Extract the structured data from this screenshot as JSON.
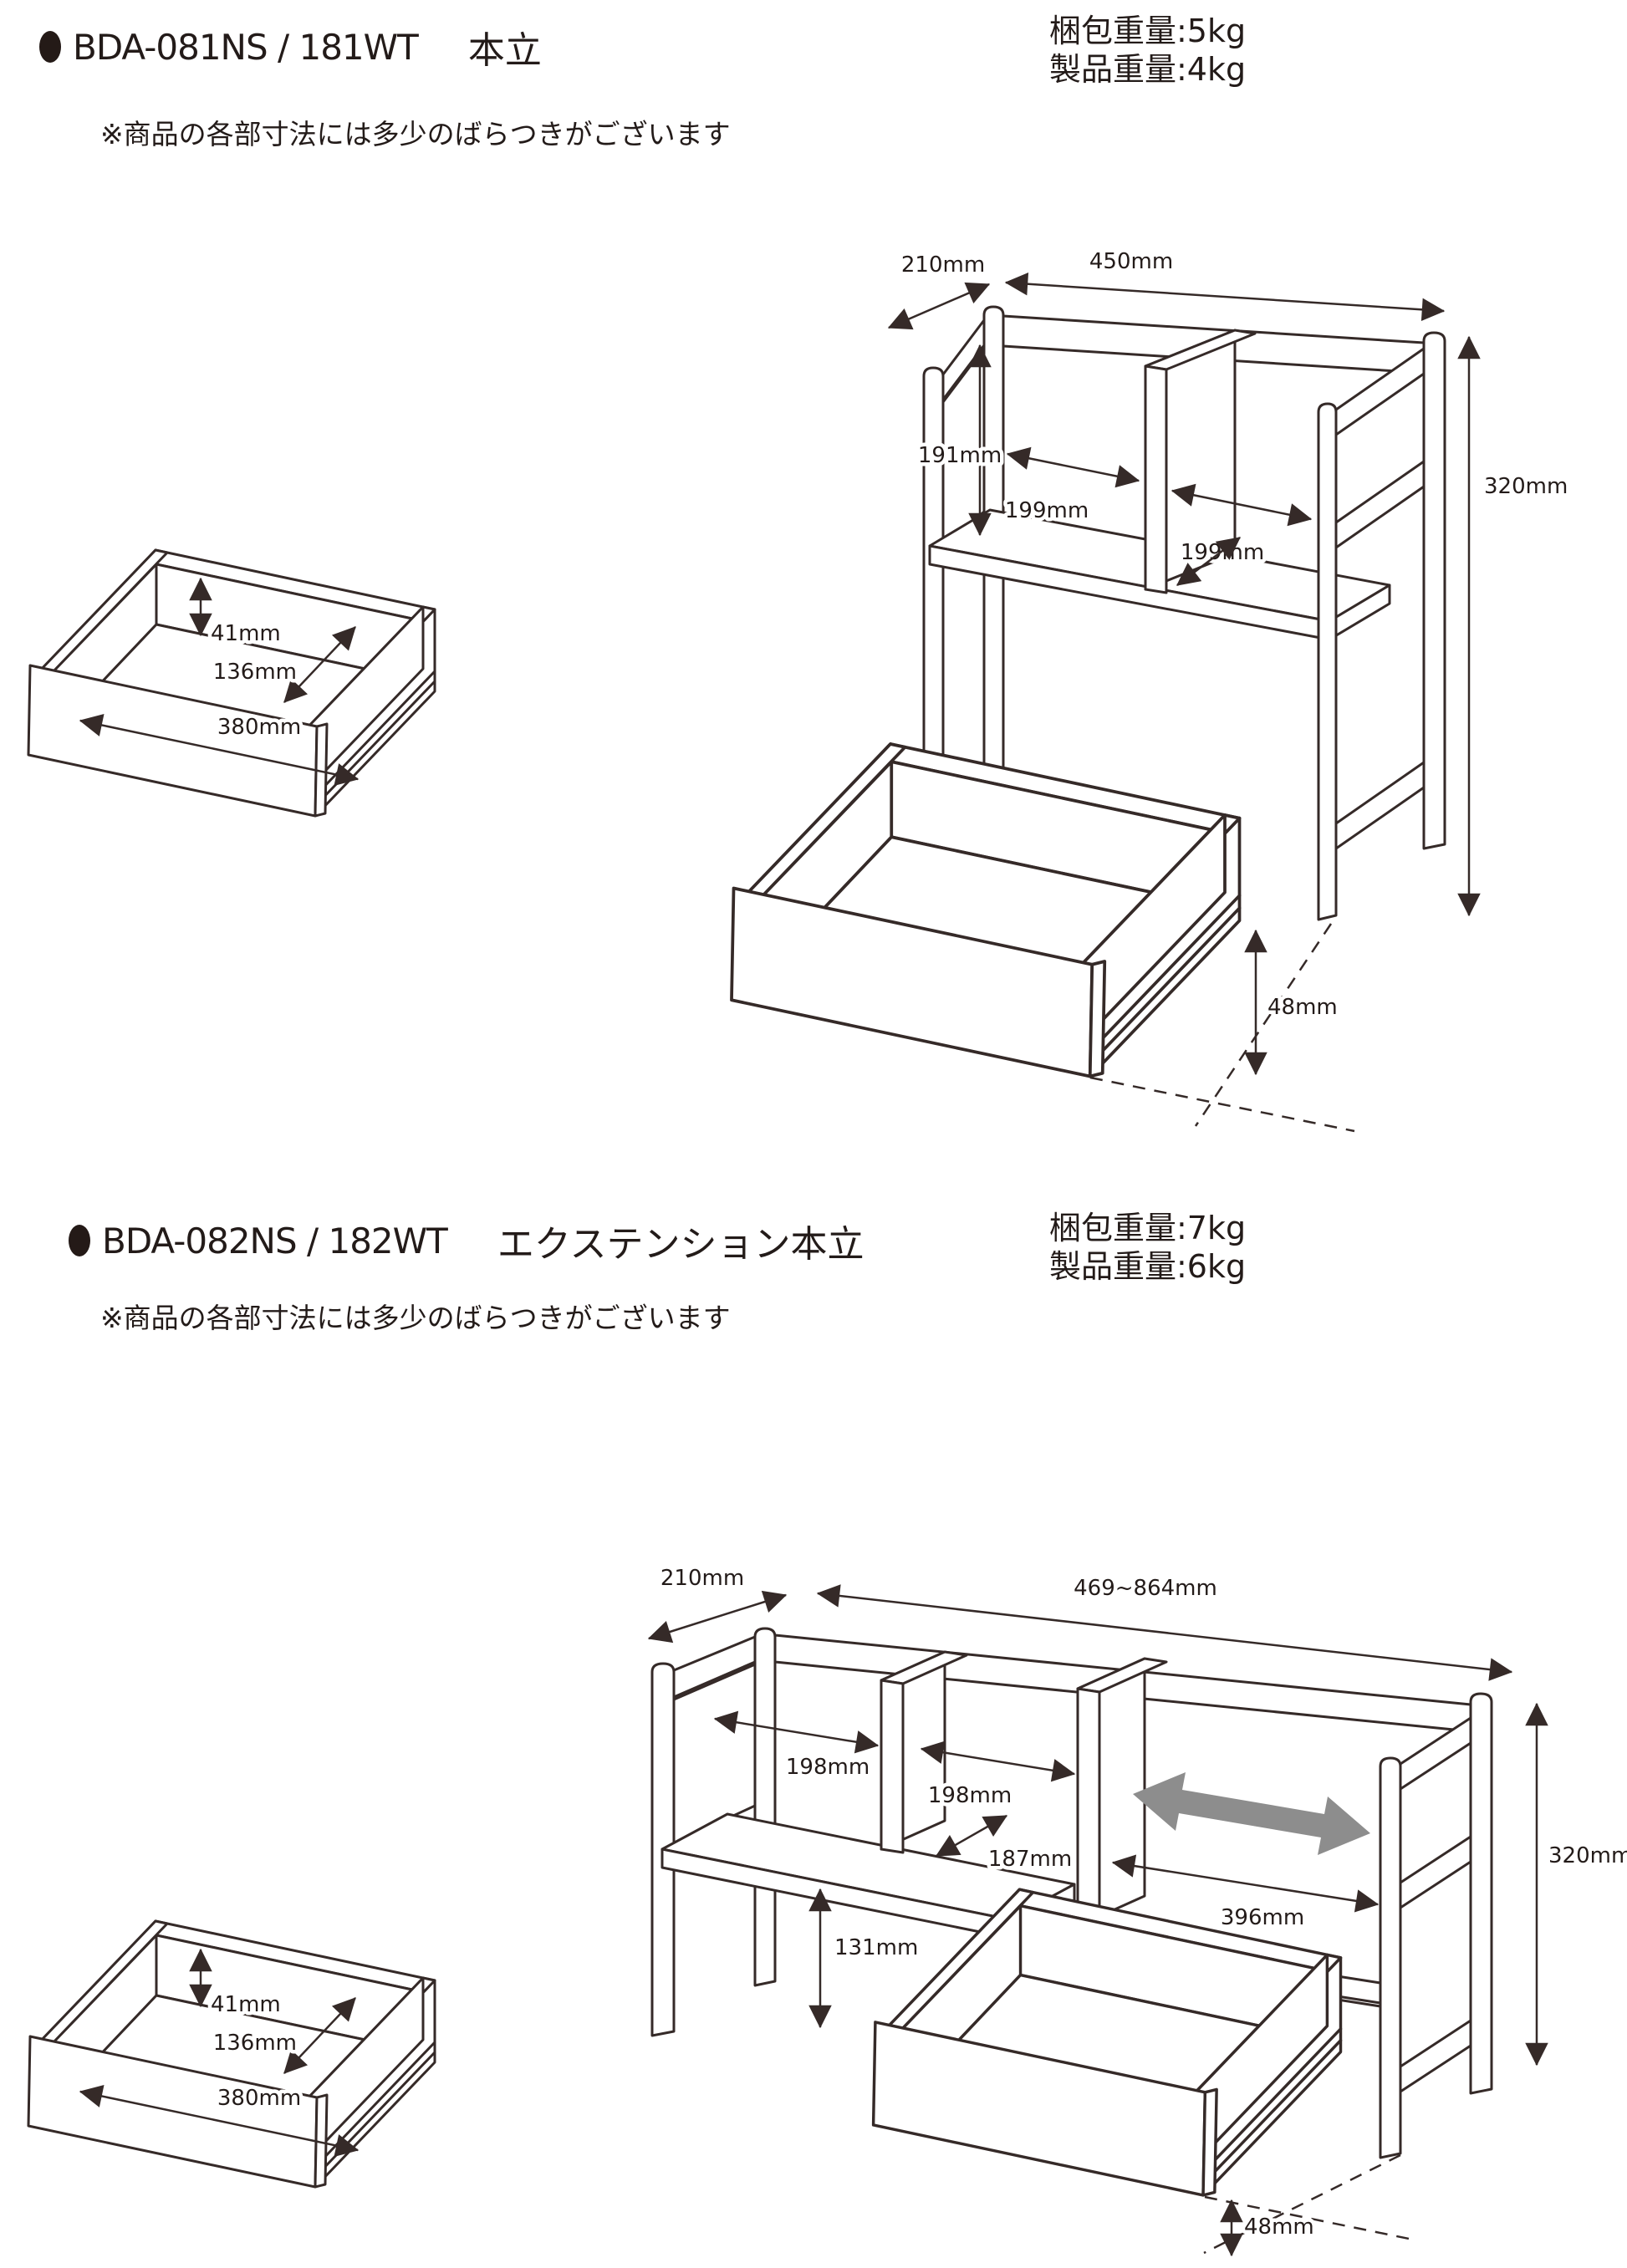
{
  "colors": {
    "line": "#352a28",
    "text": "#231b19",
    "gray_arrow": "#8d8d8d"
  },
  "products": [
    {
      "code": "BDA-081NS / 181WT",
      "name": "本立",
      "weights": {
        "packing": "梱包重量:5kg",
        "product": "製品重量:4kg"
      },
      "note": "※商品の各部寸法には多少のばらつきがございます",
      "drawer_dims": {
        "height": "41mm",
        "depth": "136mm",
        "width": "380mm"
      },
      "stand_dims": {
        "depth": "210mm",
        "width": "450mm",
        "bay_height": "191mm",
        "left_slot": "199mm",
        "right_slot": "199mm",
        "total_height": "320mm",
        "bottom_clearance": "48mm"
      }
    },
    {
      "code": "BDA-082NS / 182WT",
      "name": "エクステンション本立",
      "weights": {
        "packing": "梱包重量:7kg",
        "product": "製品重量:6kg"
      },
      "note": "※商品の各部寸法には多少のばらつきがございます",
      "drawer_dims": {
        "height": "41mm",
        "depth": "136mm",
        "width": "380mm"
      },
      "stand_dims": {
        "depth": "210mm",
        "width": "469~864mm",
        "left_slot": "198mm",
        "right_slot": "198mm",
        "shelf_depth": "187mm",
        "under_shelf": "131mm",
        "rail_length": "396mm",
        "total_height": "320mm",
        "bottom_clearance": "48mm"
      }
    }
  ]
}
